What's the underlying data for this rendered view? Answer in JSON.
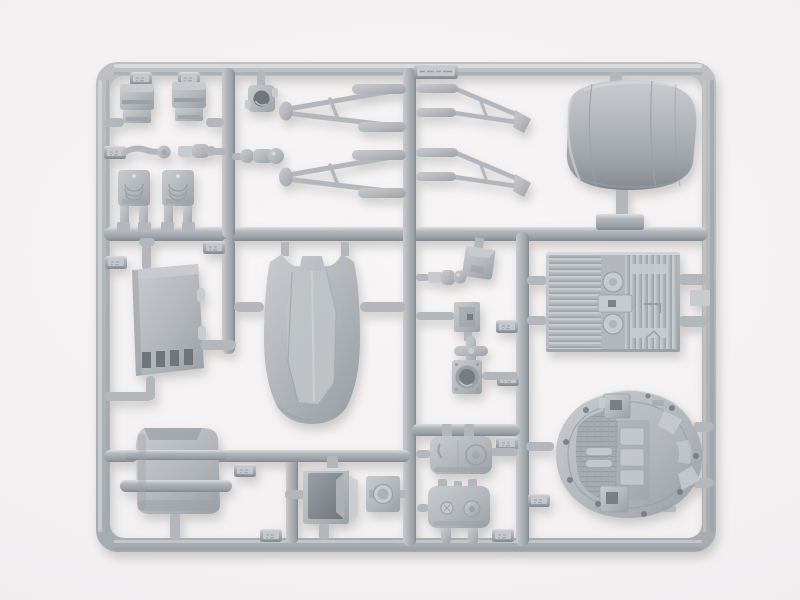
{
  "meta": {
    "type": "photograph",
    "subject": "Unassembled plastic model kit sprue (injection-molded parts tree) of unpainted light-gray styrene parts, photographed on a seamless white studio background",
    "visible_text": "none legible — only tiny embossed part-number tabs molded into the runners",
    "orientation": "rectangular runner frame with rounded corners, one full-width horizontal runner dividing top third, several vertical runners subdividing the lower area"
  },
  "colors": {
    "bg_center": "#f7f5f5",
    "bg_edge": "#f1eff0",
    "bg_corner": "#e8e6e7",
    "pl": "#b3b7bb",
    "pl_hi": "#dcdee0",
    "pl_face": "#c8cbce",
    "pl_lo": "#9aa0a5",
    "pl_dark": "#82888e",
    "pl_deep": "#6f757b",
    "shadow": "#8e8a87"
  },
  "parts": [
    {
      "id": "outer-frame",
      "desc": "rectangular runner frame, rounded corners"
    },
    {
      "id": "sprue-id-tab",
      "desc": "wide embossed identification tab on top runner (illegible)"
    },
    {
      "id": "bracket-clamp-left",
      "desc": "small stepped bracket part"
    },
    {
      "id": "bracket-clamp-right",
      "desc": "small stepped bracket part"
    },
    {
      "id": "ring-collar",
      "desc": "square collar with round bore"
    },
    {
      "id": "pivot-arm",
      "desc": "bent lever arm with disc end"
    },
    {
      "id": "cylinder-fitting-small",
      "desc": "small cylinder with end cap"
    },
    {
      "id": "cylinder-fitting-knob",
      "desc": "cylinder fitting with round knob"
    },
    {
      "id": "seat-support-left",
      "desc": "U-shaped ribbed support on two legs"
    },
    {
      "id": "seat-support-right",
      "desc": "U-shaped ribbed support on two legs"
    },
    {
      "id": "landing-strut-upper-left",
      "desc": "A-frame strut with disc foot, points left"
    },
    {
      "id": "landing-strut-lower-left",
      "desc": "A-frame strut with disc foot, points left"
    },
    {
      "id": "landing-strut-upper-right",
      "desc": "A-frame strut with angled foot, points right"
    },
    {
      "id": "landing-strut-lower-right",
      "desc": "A-frame strut with angled foot, points right"
    },
    {
      "id": "engine-cowl",
      "desc": "large rounded engine cowling / nacelle shell"
    },
    {
      "id": "vented-equipment-box",
      "desc": "boxy housing with four vent slots"
    },
    {
      "id": "hull-shell",
      "desc": "large curved hull shell with notched top"
    },
    {
      "id": "intake-duct",
      "desc": "rounded duct with two flange collars"
    },
    {
      "id": "open-bin-box",
      "desc": "open-topped bin showing hollow interior"
    },
    {
      "id": "round-port-plate",
      "desc": "flat plate with circular emblem"
    },
    {
      "id": "angled-small-box",
      "desc": "small tilted box"
    },
    {
      "id": "recessed-square-plate",
      "desc": "square plate with rectangular recess"
    },
    {
      "id": "cross-fitting",
      "desc": "plus-shaped fitting"
    },
    {
      "id": "round-recess-port",
      "desc": "square part with deep round recess"
    },
    {
      "id": "tank-pod-upper",
      "desc": "rounded tank pod with circular cap"
    },
    {
      "id": "tank-pod-lower",
      "desc": "rounded tank pod on two legs"
    },
    {
      "id": "greebled-hull-panel",
      "desc": "rectangular panel with fine ribs and circular details"
    },
    {
      "id": "cockpit-tub",
      "desc": "oval cockpit tub with gridded floor and console"
    }
  ],
  "molded_tabs": "about a dozen small blank locator tabs distributed along the runners"
}
